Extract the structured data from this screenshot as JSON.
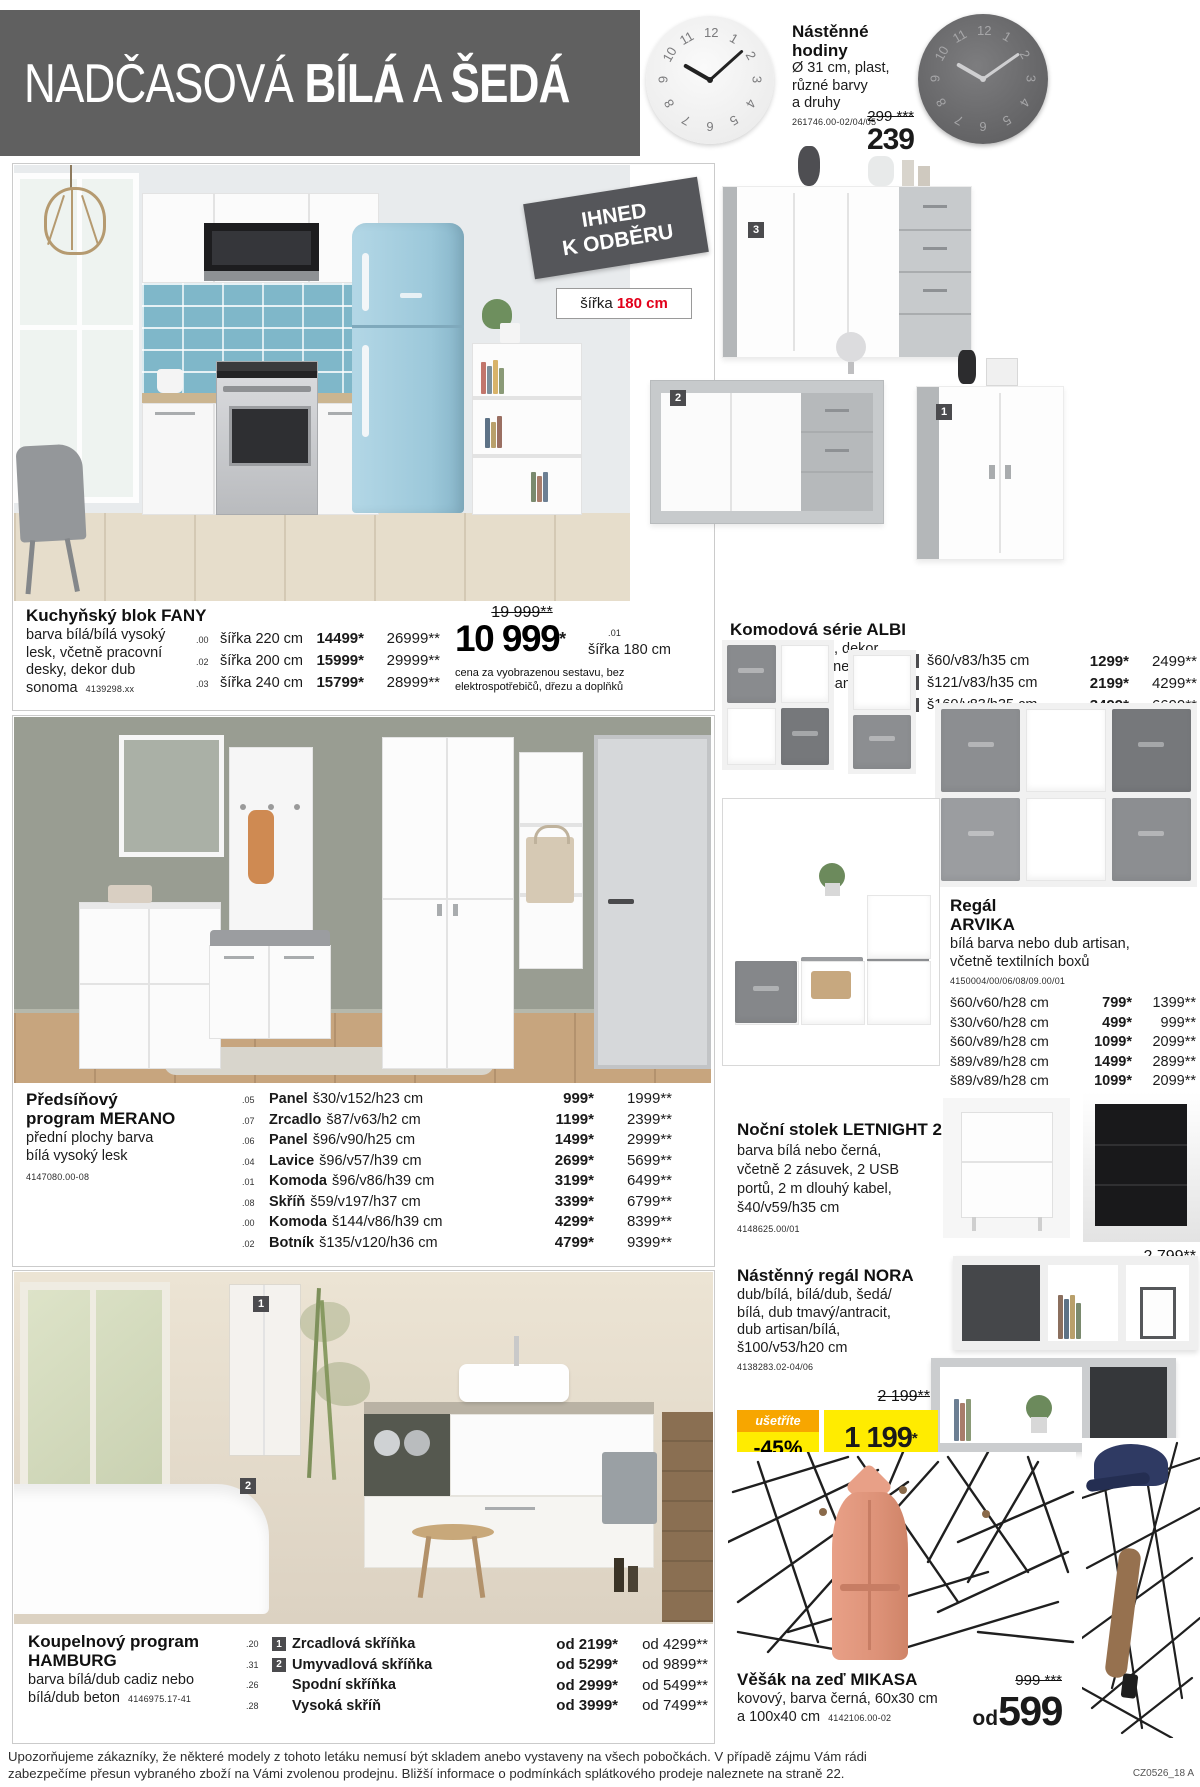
{
  "header": {
    "t1": "NADČASOVÁ",
    "t2": "BÍLÁ",
    "t3": "A",
    "t4": "ŠEDÁ"
  },
  "clock": {
    "name": "Nástěnné hodiny",
    "d1": "Ø 31 cm, plast,",
    "d2": "různé barvy",
    "d3": "a druhy",
    "code": "261746.00-02/04/05",
    "old_price": "299 ***",
    "price": "239"
  },
  "availability_badge": {
    "l1": "IHNED",
    "l2": "K ODBĚRU"
  },
  "width_label": {
    "prefix": "šířka",
    "value": "180 cm"
  },
  "kitchen": {
    "name": "Kuchyňský blok FANY",
    "d1": "barva bílá/bílá vysoký",
    "d2": "lesk, včetně pracovní",
    "d3": "desky, dekor dub",
    "d4": "sonoma",
    "code": "4139298.xx",
    "rows": [
      {
        "idx": ".00",
        "dim": "šířka 220 cm",
        "p1": "14499*",
        "p2": "26999**"
      },
      {
        "idx": ".02",
        "dim": "šířka 200 cm",
        "p1": "15999*",
        "p2": "29999**"
      },
      {
        "idx": ".03",
        "dim": "šířka 240 cm",
        "p1": "15799*",
        "p2": "28999**"
      }
    ],
    "old_price": "19 999**",
    "price": "10 999",
    "price_star": "*",
    "price_idx": ".01",
    "price_dim": "šířka 180 cm",
    "note1": "cena za vyobrazenou sestavu, bez",
    "note2": "elektrospotřebičů, dřezu a doplňků"
  },
  "albi": {
    "name": "Komodová série ALBI",
    "d1": "barva bílá/beton, dekor",
    "d2": "dub artisan/bílá nebo",
    "d3": "matera/dub artisan",
    "code": "4139324.00-06",
    "rows": [
      {
        "n": "1",
        "dim": "š60/v83/h35 cm",
        "p1": "1299*",
        "p2": "2499**"
      },
      {
        "n": "2",
        "dim": "š121/v83/h35 cm",
        "p1": "2199*",
        "p2": "4299**"
      },
      {
        "n": "3",
        "dim": "š160/v83/h35 cm",
        "p1": "3499*",
        "p2": "6699**"
      }
    ]
  },
  "merano": {
    "n1": "Předsíňový",
    "n2": "program MERANO",
    "d1": "přední plochy barva",
    "d2": "bílá vysoký lesk",
    "code": "4147080.00-08",
    "rows": [
      {
        "idx": ".05",
        "item": "Panel",
        "dim": "š30/v152/h23 cm",
        "p1": "999*",
        "p2": "1999**"
      },
      {
        "idx": ".07",
        "item": "Zrcadlo",
        "dim": "š87/v63/h2 cm",
        "p1": "1199*",
        "p2": "2399**"
      },
      {
        "idx": ".06",
        "item": "Panel",
        "dim": "š96/v90/h25 cm",
        "p1": "1499*",
        "p2": "2999**"
      },
      {
        "idx": ".04",
        "item": "Lavice",
        "dim": "š96/v57/h39 cm",
        "p1": "2699*",
        "p2": "5699**"
      },
      {
        "idx": ".01",
        "item": "Komoda",
        "dim": "š96/v86/h39 cm",
        "p1": "3199*",
        "p2": "6499**"
      },
      {
        "idx": ".08",
        "item": "Skříň",
        "dim": "š59/v197/h37 cm",
        "p1": "3399*",
        "p2": "6799**"
      },
      {
        "idx": ".00",
        "item": "Komoda",
        "dim": "š144/v86/h39 cm",
        "p1": "4299*",
        "p2": "8399**"
      },
      {
        "idx": ".02",
        "item": "Botník",
        "dim": "š135/v120/h36 cm",
        "p1": "4799*",
        "p2": "9399**"
      }
    ]
  },
  "arvika": {
    "n1": "Regál",
    "n2": "ARVIKA",
    "d1": "bílá barva nebo dub artisan,",
    "d2": "včetně textilních boxů",
    "code": "4150004/00/06/08/09.00/01",
    "rows": [
      {
        "dim": "š60/v60/h28 cm",
        "p1": "799*",
        "p2": "1399**"
      },
      {
        "dim": "š30/v60/h28 cm",
        "p1": "499*",
        "p2": "999**"
      },
      {
        "dim": "š60/v89/h28 cm",
        "p1": "1099*",
        "p2": "2099**"
      },
      {
        "dim": "š89/v89/h28 cm",
        "p1": "1499*",
        "p2": "2899**"
      },
      {
        "dim": "š89/v89/h28 cm",
        "p1": "1099*",
        "p2": "2099**"
      }
    ]
  },
  "letnight": {
    "name": "Noční stolek LETNIGHT 2",
    "d1": "barva bílá nebo černá,",
    "d2": "včetně 2 zásuvek, 2 USB",
    "d3": "portů, 2 m dlouhý kabel,",
    "d4": "š40/v59/h35 cm",
    "code": "4148625.00/01",
    "old_price": "2 799**",
    "price": "1 699",
    "price_star": "*"
  },
  "nora": {
    "name": "Nástěnný regál NORA",
    "d1": "dub/bílá, bílá/dub, šedá/",
    "d2": "bílá, dub tmavý/antracit,",
    "d3": "dub artisan/bílá,",
    "d4": "š100/v53/h20 cm",
    "code": "4138283.02-04/06",
    "old_price": "2 199**",
    "save_label": "ušetříte",
    "save_value": "-45%",
    "price": "1 199",
    "price_star": "*"
  },
  "hamburg": {
    "n1": "Koupelnový program",
    "n2": "HAMBURG",
    "d1": "barva bílá/dub cadiz nebo",
    "d2": "bílá/dub beton",
    "code": "4146975.17-41",
    "rows": [
      {
        "idx": ".20",
        "n": "1",
        "item": "Zrcadlová skříňka",
        "p1": "od 2199*",
        "p2": "od 4299**"
      },
      {
        "idx": ".31",
        "n": "2",
        "item": "Umyvadlová skříňka",
        "p1": "od 5299*",
        "p2": "od 9899**"
      },
      {
        "idx": ".26",
        "n": "",
        "item": "Spodní skříňka",
        "p1": "od 2999*",
        "p2": "od 5499**"
      },
      {
        "idx": ".28",
        "n": "",
        "item": "Vysoká skříň",
        "p1": "od 3999*",
        "p2": "od 7499**"
      }
    ]
  },
  "mikasa": {
    "name": "Věšák na zeď MIKASA",
    "d1": "kovový, barva černá, 60x30 cm",
    "d2": "a 100x40 cm",
    "code": "4142106.00-02",
    "old_price": "999 ***",
    "price_prefix": "od",
    "price": "599"
  },
  "footer": {
    "l1": "Upozorňujeme zákazníky, že některé modely z tohoto letáku nemusí být skladem anebo vystaveny na všech pobočkách. V případě zájmu Vám rádi",
    "l2": "zabezpečíme přesun vybraného zboží na Vámi zvolenou prodejnu. Bližší informace o podmínkách splátkového prodeje naleznete na straně 22.",
    "page_code": "CZ0526_18 A"
  },
  "colors": {
    "accent_red": "#e2001a",
    "badge_yellow": "#ffec00",
    "badge_orange": "#f7a600",
    "banner_gray": "#606060",
    "marker_gray": "#4b4b4e"
  }
}
